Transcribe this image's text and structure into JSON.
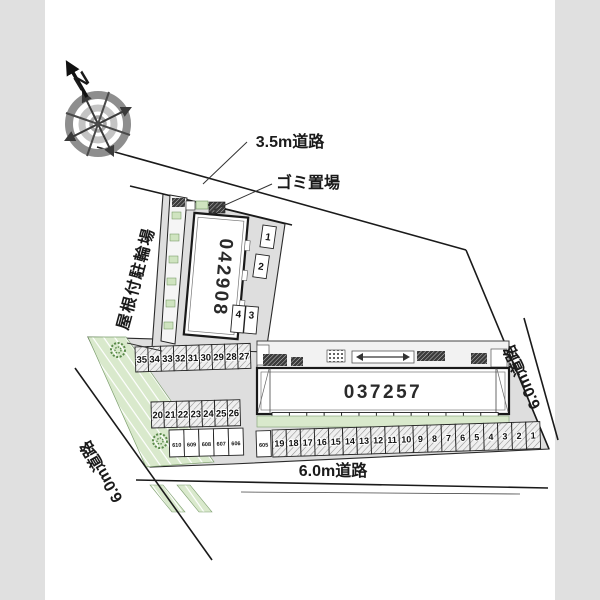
{
  "compass": {
    "north": "N"
  },
  "roads": {
    "top": "3.5m道路",
    "right": "6.0m道路",
    "bottom": "6.0m道路",
    "left": "6.0m道路"
  },
  "annotations": {
    "garbage": "ゴミ置場",
    "bike_shed": "屋根付駐輪場"
  },
  "buildings": {
    "upper": "042908",
    "lower": "037257"
  },
  "parking": {
    "upper_spaces": [
      "1",
      "2",
      "4",
      "3"
    ],
    "row_upper": [
      "35",
      "34",
      "33",
      "32",
      "31",
      "30",
      "29",
      "28",
      "27"
    ],
    "row_middle": [
      "20",
      "21",
      "22",
      "23",
      "24",
      "25",
      "26"
    ],
    "row_small": [
      "610",
      "609",
      "608",
      "607",
      "606"
    ],
    "space_605": "605",
    "row_main": [
      "19",
      "18",
      "17",
      "16",
      "15",
      "14",
      "13",
      "12",
      "11",
      "10",
      "9",
      "8",
      "7",
      "6",
      "5",
      "4",
      "3",
      "2",
      "1"
    ]
  },
  "colors": {
    "site_gray": "#dedede",
    "landscape_green": "#d9e9cc",
    "tree_green": "#5a8a4a",
    "road_line": "#1a1a1a",
    "hatch_line": "#8f8f8f",
    "margin_gray": "#e0e0e0"
  }
}
